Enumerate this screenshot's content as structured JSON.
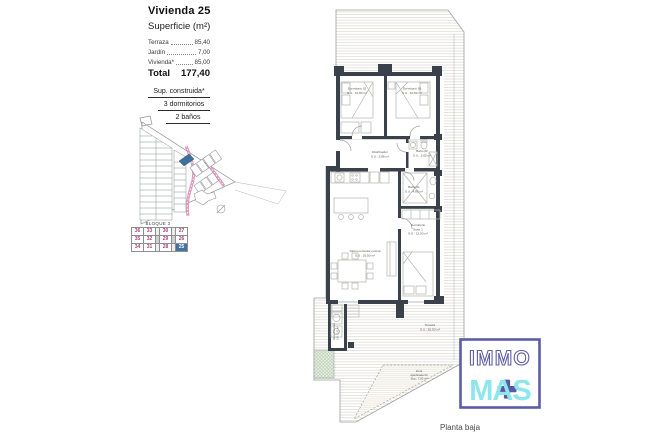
{
  "header": {
    "title": "Vivienda 25",
    "subtitle": "Superficie (m²)",
    "surface_rows": [
      {
        "label": "Terraza",
        "value": "85,40"
      },
      {
        "label": "Jardín",
        "value": "7,00"
      },
      {
        "label": "Vivienda*",
        "value": "85,00"
      }
    ],
    "total_label": "Total",
    "total_value": "177,40",
    "spec_rows": [
      "Sup. construida*",
      "3 dormitorios",
      "2 baños"
    ]
  },
  "site_plan": {
    "block_label": "BLOQUE 3",
    "rows": [
      [
        "36",
        "33",
        "30",
        "27"
      ],
      [
        "35",
        "32",
        "29",
        "26"
      ],
      [
        "34",
        "31",
        "28",
        "25"
      ]
    ],
    "highlighted_unit": "25",
    "colors": {
      "number": "#a8437c",
      "highlight_bg": "#4173a0",
      "highlight_text": "#ffffff",
      "plot_highlight": "#3f6f9a",
      "road": "#d78bb2"
    }
  },
  "floor_plan": {
    "rooms": {
      "dorm2": {
        "name": "Dormitorio 02",
        "area": "S.U.: 10,80 m²"
      },
      "dorm3": {
        "name": "Dormitorio 03",
        "area": "S.U.: 10,50 m²"
      },
      "distribuidor": {
        "name": "Distribuidor",
        "area": "S.U.: 5,88 m²"
      },
      "bath2": {
        "name": "Baño 02",
        "area": "S.U.: 3,65 m²"
      },
      "bath1": {
        "name": "Baño 01",
        "area": "S.U.: 4,85 m²"
      },
      "suite": {
        "name": "Dormitorio",
        "name2": "Suite 1",
        "area": "S.U.: 12,00 m²"
      },
      "salon": {
        "name": "Salón-comedor-cocina",
        "area": "S.U.: 25,50 m²"
      },
      "terrace": {
        "name": "Terraza",
        "area": "S.U.: 62,50 m²"
      },
      "garden": {
        "name": "Zona",
        "name2": "Ajardinada 02",
        "area": "Sup.: 7,00 m²"
      },
      "storage": {
        "name": "Almacenamiento",
        "area": "S.U.: 2,50 m²"
      }
    },
    "caption": "Planta baja",
    "colors": {
      "wall": "#3a414b",
      "hatch": "#cfccc3",
      "furniture": "#b2b2b0",
      "label": "#55554f"
    }
  },
  "logo": {
    "line1": "IMMO",
    "line2": "MAS",
    "purple": "#5c5ca8",
    "cyan": "#8ce6ec"
  }
}
